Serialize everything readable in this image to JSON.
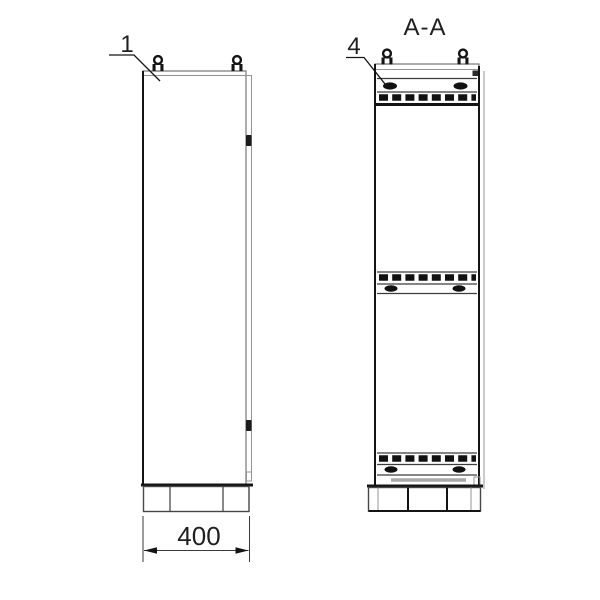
{
  "drawing": {
    "side_view": {
      "callout": "1",
      "width_dimension": "400"
    },
    "section_view": {
      "title": "A-A",
      "callout": "4"
    }
  },
  "colors": {
    "background": "#ffffff",
    "line": "#3c3c3c",
    "line-dark": "#141414",
    "line-light": "#949494",
    "fill-dark": "#111111",
    "text": "#1f1f1f"
  }
}
